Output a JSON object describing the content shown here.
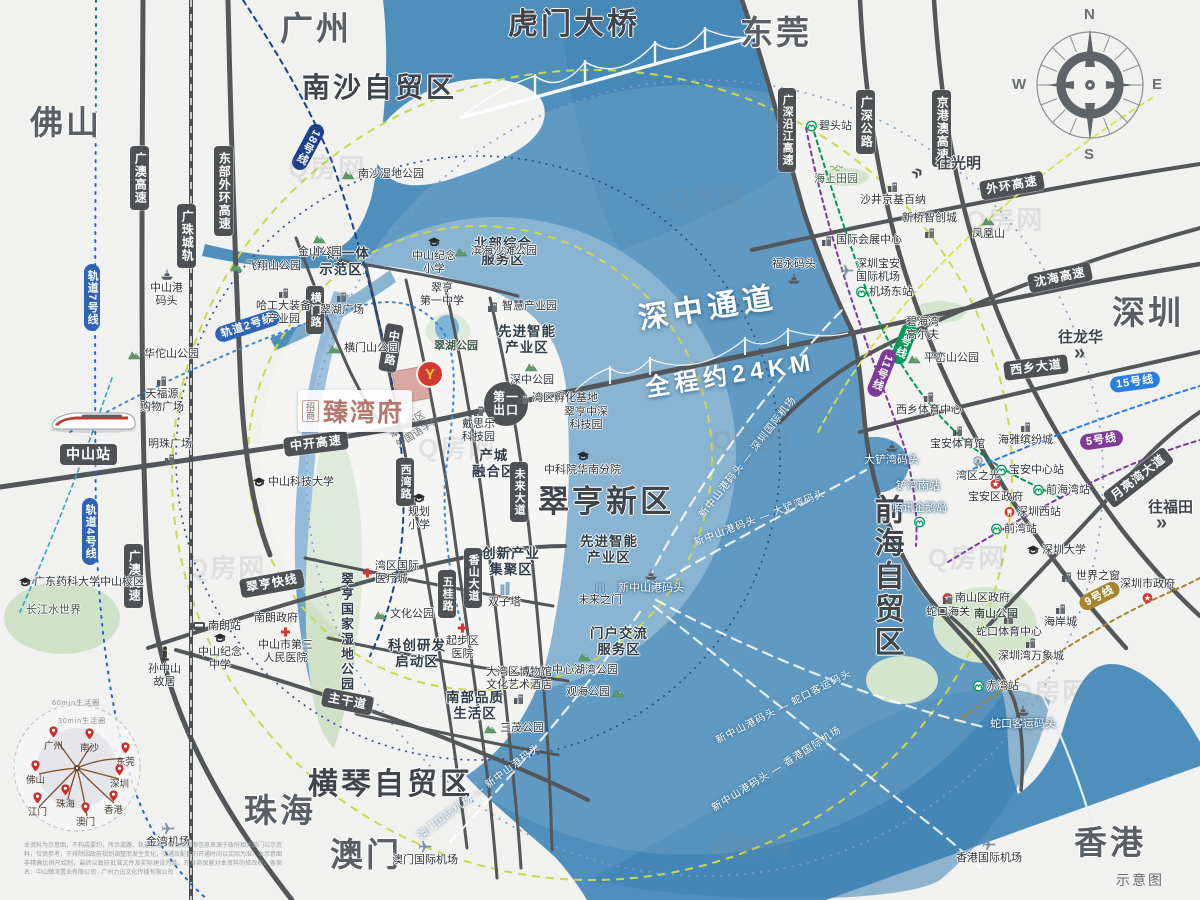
{
  "watermark": {
    "t": "Q房网"
  },
  "scale_note": {
    "t": "示意图"
  },
  "compass": {
    "n": "N",
    "e": "E",
    "s": "S",
    "w": "W"
  },
  "bridges": {
    "humen": "虎门大桥",
    "szz": "深中通道",
    "szz_sub": "全程约24KM"
  },
  "property": {
    "brand": "招商",
    "name": "臻湾府",
    "logo_glyph": "Y"
  },
  "colors": {
    "land": "#f1f1ef",
    "water": "#4f8fbc",
    "water_deep": "#3d81b1",
    "road": "#53575a",
    "metro_blue": "#2f63b8",
    "metro_navy": "#1d3f8f",
    "metro_green": "#009a57",
    "metro_purple": "#7d3c98",
    "metro_blue15": "#2a7de1",
    "metro_gold": "#a5862e",
    "ring_yellow": "#c9d84e",
    "brand_pink": "#b4786e",
    "gov_red": "#d23b34"
  },
  "cities": [
    {
      "t": "广州"
    },
    {
      "t": "东莞"
    },
    {
      "t": "佛山"
    },
    {
      "t": "深圳"
    },
    {
      "t": "珠海"
    },
    {
      "t": "澳门"
    },
    {
      "t": "香港"
    }
  ],
  "zones": [
    {
      "t": "南沙自贸区"
    },
    {
      "t": "翠亨新区"
    },
    {
      "t": "横琴自贸区"
    },
    {
      "t": "前海自贸区"
    }
  ],
  "subzones": [
    {
      "t": "产研一体\n示范区"
    },
    {
      "t": "北部综合\n服务区"
    },
    {
      "t": "先进智能\n产业区"
    },
    {
      "t": "先进智能\n产业区"
    },
    {
      "t": "产城\n融合区"
    },
    {
      "t": "创新产业\n集聚区"
    },
    {
      "t": "科创研发\n启动区"
    },
    {
      "t": "南部品质\n生活区"
    },
    {
      "t": "门户交流\n服务区"
    },
    {
      "t": "翠亨国家湿地公园"
    }
  ],
  "road_signs": [
    {
      "t": "广澳高速"
    },
    {
      "t": "东部外环高速"
    },
    {
      "t": "广珠城轨"
    },
    {
      "t": "横门路"
    },
    {
      "t": "中世路"
    },
    {
      "t": "西湾路"
    },
    {
      "t": "五桂路"
    },
    {
      "t": "香山大道"
    },
    {
      "t": "未来大道"
    },
    {
      "t": "中开高速"
    },
    {
      "t": "翠亨快线"
    },
    {
      "t": "主干道"
    },
    {
      "t": "广澳高速"
    },
    {
      "t": "第一\n出口"
    },
    {
      "t": "广深沿江高速"
    },
    {
      "t": "广深公路"
    },
    {
      "t": "京港澳高速"
    },
    {
      "t": "外环高速"
    },
    {
      "t": "沈海高速"
    },
    {
      "t": "西乡大道"
    },
    {
      "t": "月亮湾大道"
    },
    {
      "t": "中山站"
    }
  ],
  "metro_signs": [
    {
      "t": "轨道7号线",
      "c": "#2f63b8"
    },
    {
      "t": "轨道4号线",
      "c": "#2f63b8"
    },
    {
      "t": "轨道2号线",
      "c": "#2f63b8"
    },
    {
      "t": "18号线",
      "c": "#1d3f8f"
    },
    {
      "t": "1号线",
      "c": "#009a57"
    },
    {
      "t": "11号线",
      "c": "#7d3c98"
    },
    {
      "t": "15号线",
      "c": "#2a7de1"
    },
    {
      "t": "5号线",
      "c": "#7d3c98"
    },
    {
      "t": "9号线",
      "c": "#a5862e"
    }
  ],
  "stations": [
    {
      "t": "碧头站"
    },
    {
      "t": "机场东站"
    },
    {
      "t": "宝安中心站"
    },
    {
      "t": "前海湾站"
    },
    {
      "t": "前湾站"
    },
    {
      "t": "赤湾站"
    },
    {
      "t": "南朗站"
    }
  ],
  "places": [
    {
      "t": "南沙湿地公园"
    },
    {
      "t": "金山公园"
    },
    {
      "t": "飞翔山公园"
    },
    {
      "t": "哈工大装备\n产业园"
    },
    {
      "t": "翠湖广场"
    },
    {
      "t": "中山港\n码头"
    },
    {
      "t": "华佗山公园"
    },
    {
      "t": "天福源\n购物广场"
    },
    {
      "t": "横门山公园"
    },
    {
      "t": "明珠广场"
    },
    {
      "t": "广东药科大学中山校区"
    },
    {
      "t": "长江水世界"
    },
    {
      "t": "孙中山\n故居"
    },
    {
      "t": "中山纪念\n中学"
    },
    {
      "t": "南朗政府"
    },
    {
      "t": "中山市第三\n人民医院"
    },
    {
      "t": "金湾机场"
    },
    {
      "t": "澳门国际机场"
    },
    {
      "t": "中山科技大学"
    },
    {
      "t": "中山纪念\n小学"
    },
    {
      "t": "滨海沙滩公园"
    },
    {
      "t": "翠亨\n第一中学"
    },
    {
      "t": "智慧产业园"
    },
    {
      "t": "翠湖公园"
    },
    {
      "t": "深中公园"
    },
    {
      "t": "湾区孵化基地"
    },
    {
      "t": "翠亨中深\n科技园"
    },
    {
      "t": "戴思乐\n科技园"
    },
    {
      "t": "中科院华南分院"
    },
    {
      "t": "湾区国际\n医疗城"
    },
    {
      "t": "规划\n小学"
    },
    {
      "t": "翠亨新区\n外国语学校"
    },
    {
      "t": "文化公园"
    },
    {
      "t": "双子塔"
    },
    {
      "t": "起步区\n医院"
    },
    {
      "t": "大湾区博物馆\n文化艺术酒店"
    },
    {
      "t": "中心湖湾公园"
    },
    {
      "t": "观海公园"
    },
    {
      "t": "三茂公园"
    },
    {
      "t": "未来之门"
    },
    {
      "t": "新中山港码头"
    },
    {
      "t": "海上田园"
    },
    {
      "t": "沙井京基百纳"
    },
    {
      "t": "新桥智创城"
    },
    {
      "t": "凤凰山"
    },
    {
      "t": "国际会展中心"
    },
    {
      "t": "深圳宝安\n国际机场"
    },
    {
      "t": "碧海湾\n高尔夫"
    },
    {
      "t": "平峦山公园"
    },
    {
      "t": "西乡体育中心"
    },
    {
      "t": "宝安体育馆"
    },
    {
      "t": "海雅缤纷城"
    },
    {
      "t": "宝安区政府"
    },
    {
      "t": "深圳西站"
    },
    {
      "t": "深圳大学"
    },
    {
      "t": "世界之窗"
    },
    {
      "t": "深圳市政府"
    },
    {
      "t": "南山区政府"
    },
    {
      "t": "南山公园"
    },
    {
      "t": "蛇口海关"
    },
    {
      "t": "蛇口体育中心"
    },
    {
      "t": "海岸城"
    },
    {
      "t": "深圳湾万象城"
    },
    {
      "t": "蛇口客运码头"
    },
    {
      "t": "大铲湾码头"
    },
    {
      "t": "铲湾南站"
    },
    {
      "t": "腾讯企鹅岛"
    },
    {
      "t": "福永码头"
    },
    {
      "t": "香港国际机场"
    },
    {
      "t": "湾区之光"
    }
  ],
  "ferries": [
    {
      "t": "新中山港码头 — 深圳国际机场"
    },
    {
      "t": "新中山港码头 — 大铲湾码头"
    },
    {
      "t": "新中山港码头 — 蛇口客运码头"
    },
    {
      "t": "新中山港码头 — 香港国际机场"
    },
    {
      "t": "澳门国际机场 — 新中山港码头"
    }
  ],
  "directions": [
    {
      "t": "往光明",
      "a": "»"
    },
    {
      "t": "往龙华",
      "a": "»"
    },
    {
      "t": "往福田",
      "a": "»"
    }
  ],
  "living_circle": {
    "outer": "60min生活圈",
    "inner": "30min生活圈",
    "cities": [
      {
        "t": "广州"
      },
      {
        "t": "南沙"
      },
      {
        "t": "东莞"
      },
      {
        "t": "深圳"
      },
      {
        "t": "香港"
      },
      {
        "t": "澳门"
      },
      {
        "t": "珠海"
      },
      {
        "t": "江门"
      },
      {
        "t": "佛山"
      }
    ]
  },
  "disclaimer": {
    "t": "本资料为示意图，不构成要约，所示道路、轨道交通、规划配套等信息来源于政府相关部门公示资料，仅供参考，不排除因政府规划调整而发生变化，交通及配套的开通时间以实际为准。本示意图非精确比例尺绘制，最终以政府批准文件及实际建设为准。开发商保留对本资料的修改权。备案名：中山臻湾置业有限公司 · 广州力迅文化传播有限公司"
  }
}
